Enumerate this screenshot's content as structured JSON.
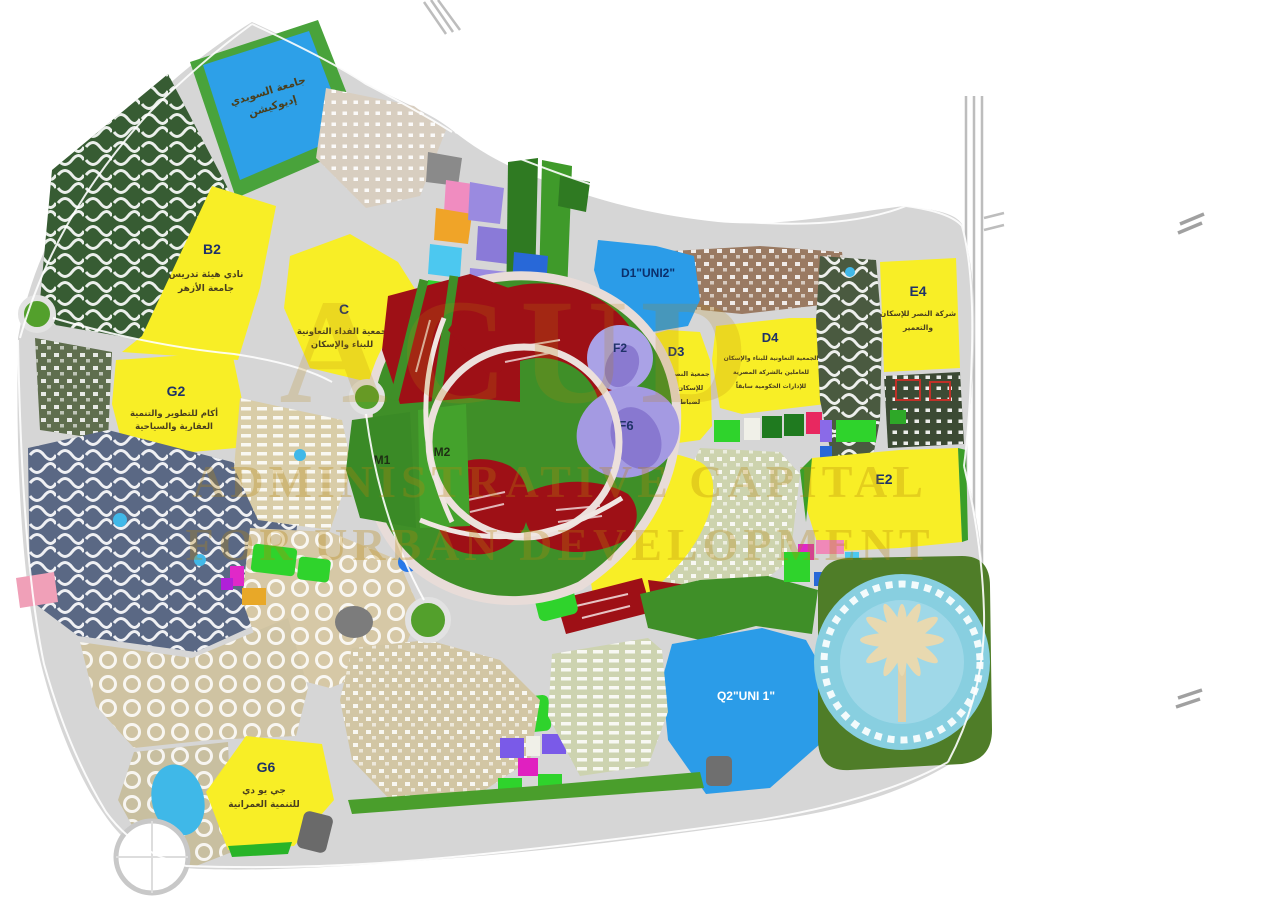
{
  "map": {
    "kind": "city-master-plan",
    "watermark": {
      "brand": "ACUD",
      "line1": "ADMINISTRATIVE CAPITAL",
      "line2": "FOR URBAN DEVELOPMENT",
      "color": "#b8860b"
    },
    "palette": {
      "road_gray": "#d6d6d6",
      "zone_yellow": "#f8ee26",
      "zone_red": "#9e1016",
      "zone_blue": "#2b9ce8",
      "zone_lavender": "#a8a0e4",
      "park_green": "#3f9428",
      "bright_green": "#2fd32c",
      "residential_tan": "#d6c9a8",
      "lake_blue": "#2da0e8"
    },
    "zones": {
      "lake": {
        "l1": "جامعة السويدي",
        "l2": "إديوكيشن"
      },
      "b2": {
        "code": "B2",
        "l1": "نادي هيئة تدريس",
        "l2": "جامعة الأزهر"
      },
      "c": {
        "code": "C",
        "l1": "جمعية الفداء التعاونية",
        "l2": "للبناء والإسكان"
      },
      "g2": {
        "code": "G2",
        "l1": "أكام للتطوير والتنمية",
        "l2": "العقارية والسياحية"
      },
      "g6": {
        "code": "G6",
        "l1": "جي يو دي",
        "l2": "للتنمية العمرانية"
      },
      "m1": {
        "code": "M1"
      },
      "m2": {
        "code": "M2"
      },
      "f2": {
        "code": "F2"
      },
      "f6": {
        "code": "F6"
      },
      "d1": {
        "code": "D1\"UNI2\""
      },
      "d3": {
        "code": "D3",
        "l1": "جمعية النصر الزراعي",
        "l2": "للإسكان التعاوني",
        "l3": "لضباط الشرطة"
      },
      "d4": {
        "code": "D4",
        "l1": "الجمعية التعاونية للبناء والإسكان",
        "l2": "للعاملين بالشركة المصرية",
        "l3": "للإدارات الحكومية سابقاً"
      },
      "e4": {
        "code": "E4",
        "l1": "شركة النصر للإسكان",
        "l2": "والتعمير"
      },
      "e2": {
        "code": "E2"
      },
      "i1": {
        "code": "I1"
      },
      "q2": {
        "code": "Q2\"UNI 1\""
      }
    }
  }
}
